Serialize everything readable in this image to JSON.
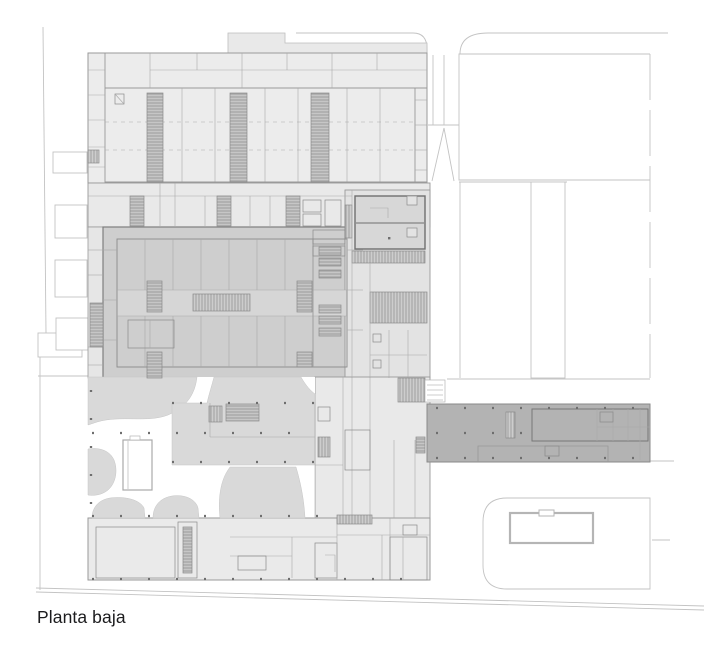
{
  "caption": {
    "text": "Planta baja"
  },
  "palette": {
    "paper": "#ffffff",
    "building_light": "#ececec",
    "building_mid": "#e9e9e9",
    "building_dark": "#cecece",
    "corridor": "#d6d6d6",
    "wing_band": "#b3b3b3",
    "plaza_patch": "#d9d9d9",
    "plant_block": "#d7d7d7",
    "hatch_base": "#c6c6c6",
    "line": "#9a9a9a",
    "wall": "#7a7a7a",
    "context_line": "#c3c3c3",
    "caption_text": "#1c1c1e"
  }
}
